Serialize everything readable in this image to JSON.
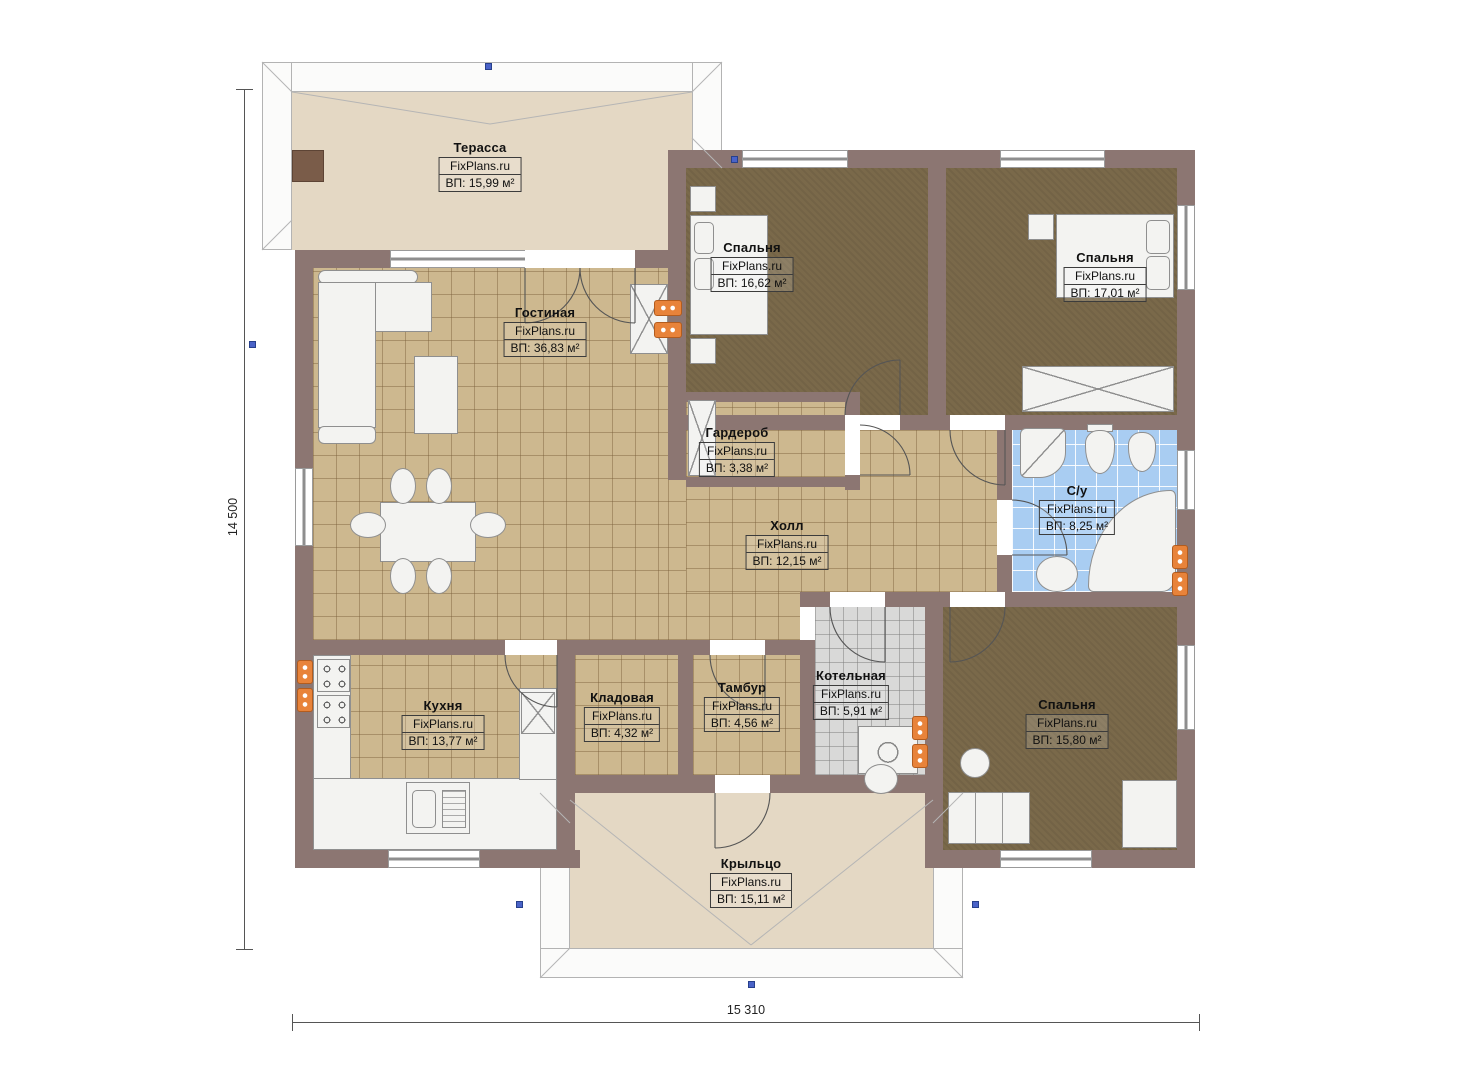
{
  "plan": {
    "brand": "FixPlans.ru",
    "type": "single-storey house floor plan"
  },
  "dimensions": {
    "height_label": "14 500",
    "width_label": "15 310"
  },
  "rooms": [
    {
      "id": "terrace",
      "name": "Терасса",
      "brand": "FixPlans.ru",
      "area": "ВП: 15,99 м²"
    },
    {
      "id": "living",
      "name": "Гостиная",
      "brand": "FixPlans.ru",
      "area": "ВП: 36,83 м²"
    },
    {
      "id": "bedroom1",
      "name": "Спальня",
      "brand": "FixPlans.ru",
      "area": "ВП: 16,62 м²"
    },
    {
      "id": "bedroom2",
      "name": "Спальня",
      "brand": "FixPlans.ru",
      "area": "ВП: 17,01 м²"
    },
    {
      "id": "wardrobe",
      "name": "Гардероб",
      "brand": "FixPlans.ru",
      "area": "ВП: 3,38 м²"
    },
    {
      "id": "hall",
      "name": "Холл",
      "brand": "FixPlans.ru",
      "area": "ВП: 12,15 м²"
    },
    {
      "id": "bathroom",
      "name": "С/у",
      "brand": "FixPlans.ru",
      "area": "ВП: 8,25 м²"
    },
    {
      "id": "kitchen",
      "name": "Кухня",
      "brand": "FixPlans.ru",
      "area": "ВП: 13,77 м²"
    },
    {
      "id": "pantry",
      "name": "Кладовая",
      "brand": "FixPlans.ru",
      "area": "ВП: 4,32 м²"
    },
    {
      "id": "vestibule",
      "name": "Тамбур",
      "brand": "FixPlans.ru",
      "area": "ВП: 4,56 м²"
    },
    {
      "id": "boiler",
      "name": "Котельная",
      "brand": "FixPlans.ru",
      "area": "ВП: 5,91 м²"
    },
    {
      "id": "bedroom3",
      "name": "Спальня",
      "brand": "FixPlans.ru",
      "area": "ВП: 15,80 м²"
    },
    {
      "id": "porch",
      "name": "Крыльцо",
      "brand": "FixPlans.ru",
      "area": "ВП: 15,11 м²"
    }
  ],
  "colors": {
    "wall": "#8c7672",
    "tile_beige": "#cdb88f",
    "floor_bedroom": "#7a694a",
    "tile_blue": "#a9cdf2",
    "tile_gray": "#d9d9d8",
    "terrace_floor": "#e4d8c4",
    "radiator": "#e8833a",
    "roof_marker": "#4a63c8"
  },
  "icons": [
    "radiator-icon",
    "stove-icon",
    "kitchen-sink-icon",
    "fridge-icon",
    "sofa-icon",
    "coffee-table-icon",
    "dining-table-icon",
    "chair-icon",
    "fireplace-icon",
    "bed-icon",
    "pillow-icon",
    "nightstand-icon",
    "wardrobe-x-icon",
    "washbasin-icon",
    "toilet-icon",
    "bidet-icon",
    "corner-bath-icon",
    "washing-machine-icon",
    "boiler-icon",
    "dresser-icon",
    "stool-icon",
    "chimney-icon",
    "roof-marker-icon"
  ]
}
